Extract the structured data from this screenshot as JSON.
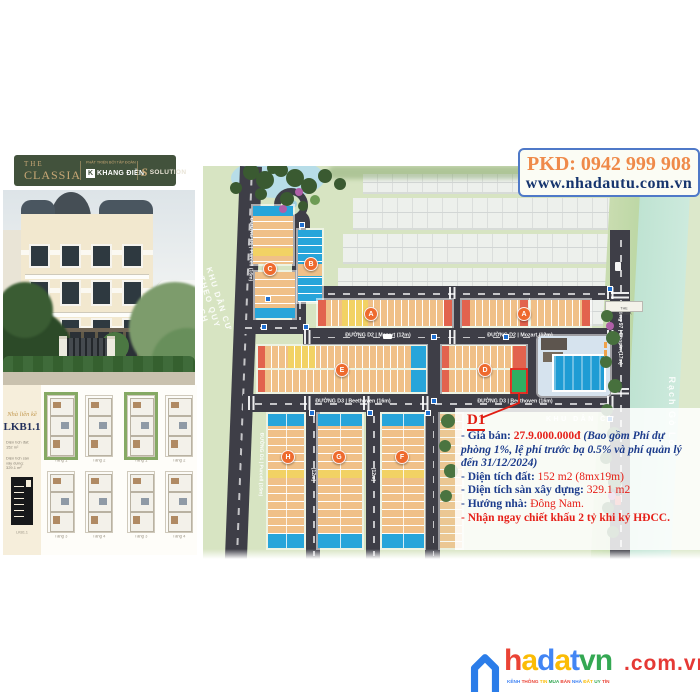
{
  "brand": {
    "the": "THE",
    "classia": "CLASSIA",
    "developer_prefix": "PHÁT TRIỂN BỞI TẬP ĐOÀN",
    "developer": "KHANG ĐIỀN",
    "partner": "SOLUTION"
  },
  "contact": {
    "phone": "PKD: 0942 999 908",
    "website": "www.nhadautu.com.vn"
  },
  "plans": {
    "category": "Nhà liền kề",
    "model": "LKB1.1",
    "spec1": "Diện tích đất: 152 m²",
    "spec2": "Diện tích sàn xây dựng: 329.1 m²",
    "floors": [
      "Tầng 1",
      "Tầng 2",
      "Tầng 1",
      "Tầng 2",
      "Tầng 3",
      "Tầng 4",
      "Tầng 3",
      "Tầng 4"
    ]
  },
  "map": {
    "roads": {
      "purcell": "ĐƯỜNG D1 | Purcell (16m)",
      "mozart": "ĐƯỜNG D2 | Mozart (12m)",
      "beethoven": "ĐƯỜNG D3 | Beethoven (16m)",
      "chopin": "Đường 97 | Chopin (17m)",
      "small": "(12m)"
    },
    "labels": {
      "planned_area": "KHU DÂN CƯ THEO QUY HOẠCH",
      "residential": "KHU DÂN CƯ",
      "river": "Rạch Gò Lớn",
      "gate": "THE CLASSIA"
    },
    "markers": [
      {
        "letter": "C"
      },
      {
        "letter": "B"
      },
      {
        "letter": "A"
      },
      {
        "letter": "A"
      },
      {
        "letter": "E"
      },
      {
        "letter": "D"
      },
      {
        "letter": "H"
      },
      {
        "letter": "G"
      },
      {
        "letter": "F"
      }
    ]
  },
  "listing": {
    "lot": "D1",
    "price_label": "- Giá bán: ",
    "price": "27.9.000.000đ ",
    "price_note": "(Bao gồm Phí dự phòng 1%, lệ phí trước bạ 0.5% và phí quản lý đến 31/12/2024)",
    "land_label": "- Diện tích đất: ",
    "land": "152 m2 (8mx19m)",
    "floor_label": "- Diện tích sàn xây dựng: ",
    "floor": "329.1 m2",
    "direction_label": "- Hướng nhà: ",
    "direction": "Đông Nam.",
    "promo": "- Nhận ngay chiết khấu 2 tỷ khi ký HĐCC."
  },
  "footer": {
    "letters": [
      [
        "h",
        "#ea4335"
      ],
      [
        "a",
        "#fbbc05"
      ],
      [
        "d",
        "#4285f4"
      ],
      [
        "a",
        "#fbbc05"
      ],
      [
        "t",
        "#4285f4"
      ],
      [
        "v",
        "#34a853"
      ],
      [
        "n",
        "#34a853"
      ]
    ],
    "suffix": ".com.vn",
    "tagline": [
      [
        "KÊNH",
        "#4285f4"
      ],
      [
        "THÔNG",
        "#ea4335"
      ],
      [
        "TIN",
        "#fbbc05"
      ],
      [
        "MUA",
        "#34a853"
      ],
      [
        "BÁN",
        "#ea4335"
      ],
      [
        "NHÀ",
        "#4285f4"
      ],
      [
        "ĐẤT",
        "#fbbc05"
      ],
      [
        "UY",
        "#34a853"
      ],
      [
        "TÍN",
        "#ea4335"
      ]
    ]
  },
  "colors": {
    "brand_green": "#42523c",
    "gold": "#c9a876",
    "navy": "#1c3c8c",
    "red": "#e62019",
    "orange": "#ef8a4a",
    "website_navy": "#16356e",
    "road": "#3e3e47",
    "land": "#d7e4c2",
    "river": "#c9e8da",
    "lot_tan": "#f0c088",
    "lot_yellow": "#f2d264",
    "lot_red": "#e2634e",
    "lot_blue": "#27a5da",
    "lot_green": "#2fae62",
    "marker": "#ee6a2e",
    "pool": "#1f9cd4"
  }
}
